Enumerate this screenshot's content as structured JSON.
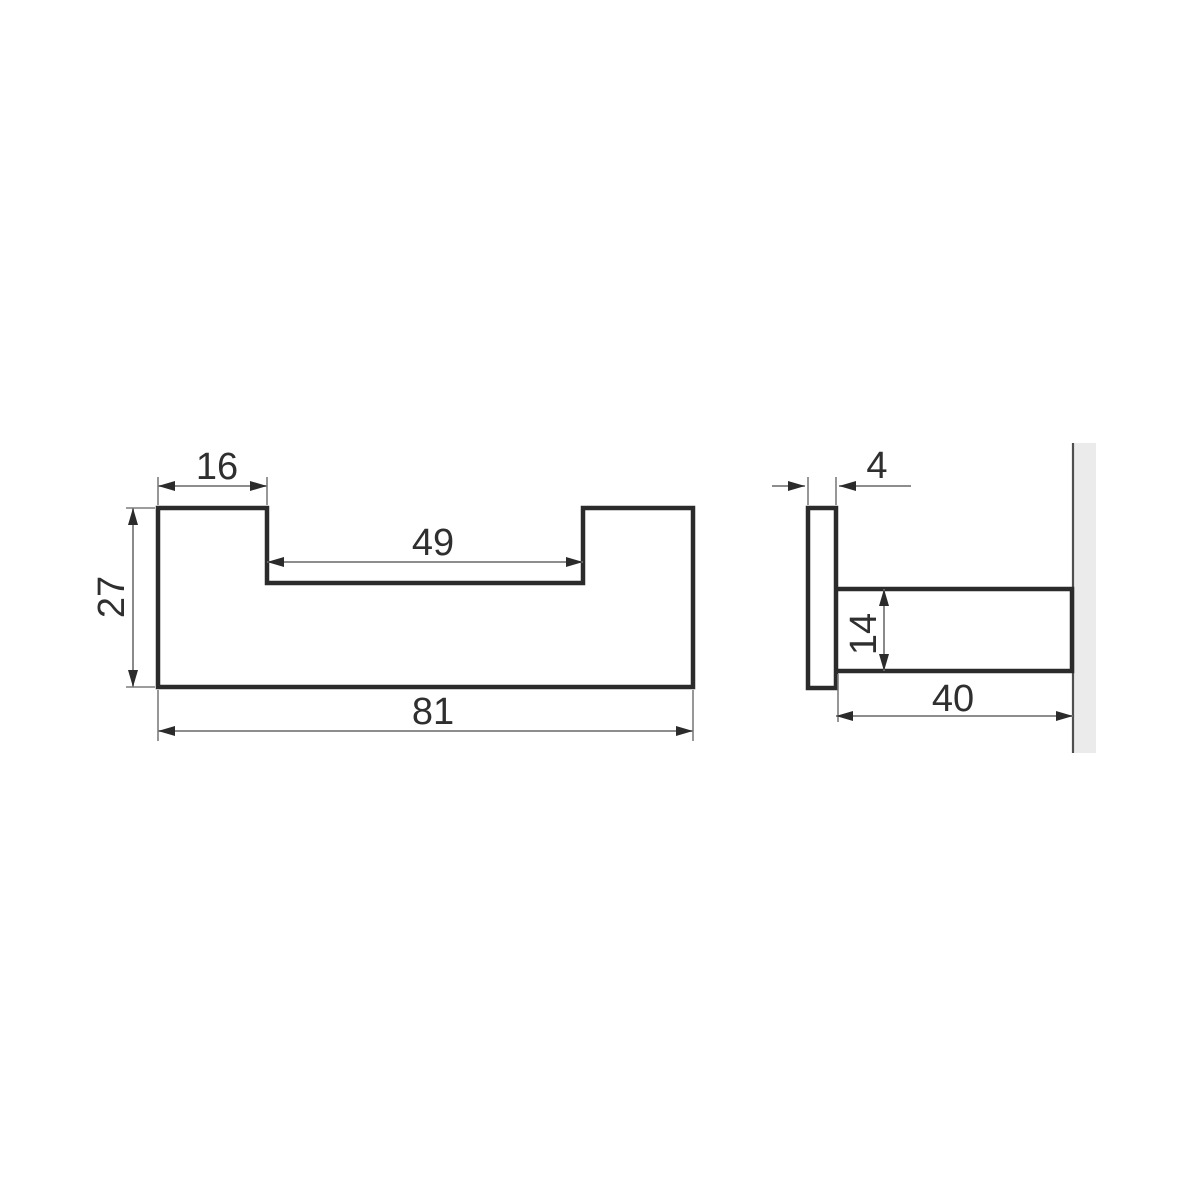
{
  "drawing": {
    "kind": "technical-dimension-drawing",
    "part": "double wall hook profile",
    "units_shown": "mm"
  },
  "front_view": {
    "tab_width": "16",
    "slot_width": "49",
    "height": "27",
    "overall_width": "81"
  },
  "side_view": {
    "plate_thickness": "4",
    "arm_height": "14",
    "arm_length": "40"
  },
  "colors": {
    "background": "#ffffff",
    "outline": "#2b2b2b",
    "dimension_line": "#7d7d7d",
    "arrowhead": "#2b2b2b",
    "label_text": "#2f2f2f",
    "wall_fill": "#ebebeb",
    "wall_edge": "#4f4f4f"
  }
}
